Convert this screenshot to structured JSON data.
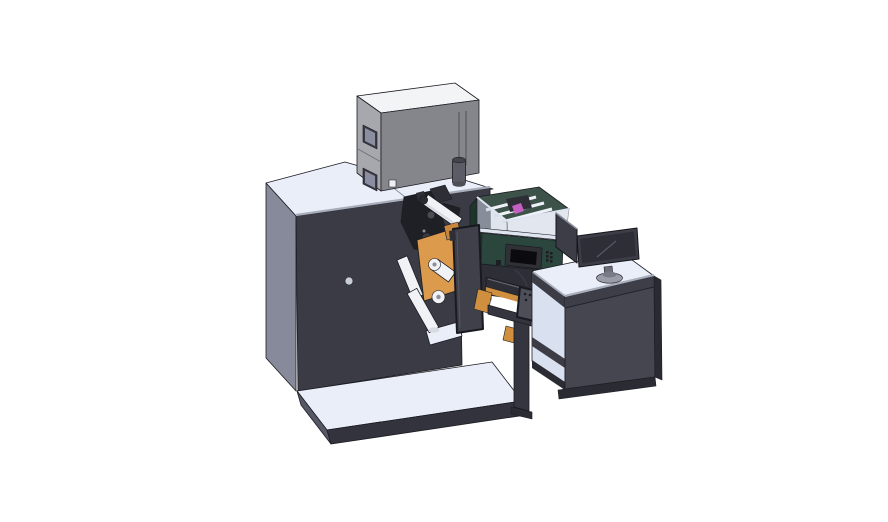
{
  "colors": {
    "background": "#ffffff",
    "top_surface": "#e9eef9",
    "machine_left": "#878a9a",
    "machine_front": "#3b3b46",
    "platform_left": "#565866",
    "platform_front": "#33333d",
    "box_top": "#f3f4f6",
    "box_left": "#a7a8ad",
    "box_front": "#85868c",
    "box_window_frame": "#3b3b46",
    "box_window_glass": "#8b8da0",
    "box_square": "#f0f0f3",
    "cylinder_body": "#5c5c66",
    "cylinder_top": "#44444c",
    "cylinder_base": "#4e4e57",
    "enclosure_glass": "#c7d0e0",
    "enclosure_interior": "#3d5249",
    "enclosure_rib": "#eef1f7",
    "housing_green": "#2b463d",
    "housing_green_dark": "#1f352c",
    "rim_bar": "#dfe5f0",
    "hmi_frame": "#303037",
    "hmi_screen": "#0b0b0f",
    "hmi_button": "#1d1d24",
    "mech_dark": "#1f1f26",
    "mech_mid": "#2e2e36",
    "mech_detail": "#3a3a42",
    "mech_detail2": "#4a4a52",
    "roller_white": "#f0f2f6",
    "roller_shade": "#d8dae2",
    "roller_hub": "#8a8d99",
    "roller_cap": "#2a2a31",
    "orange": "#dc9a4c",
    "orange_wedge": "#c8873c",
    "orange_dark": "#cf8f3f",
    "magenta": "#c45fc4",
    "door_panel": "#40404b",
    "door_tab": "#2e2e36",
    "door_line": "#55555f",
    "conveyor_dark": "#2e2e37",
    "leg_dark": "#35353f",
    "foot_dark": "#2b2b33",
    "desk_front": "#464650",
    "desk_front_upper": "#3e3e48",
    "desk_side_dark": "#2a2a32",
    "desk_interior": "#d9e0ef",
    "desk_member": "#3c3c46",
    "desk_kick": "#2b2b33",
    "monitor_frame": "#3d3d47",
    "monitor_screen": "#2e2e37",
    "monitor_reflection": "#565663",
    "monitor_neck": "#6e6e78",
    "monitor_base": "#9a9ca8",
    "monitor_hub": "#787a86",
    "pendant": "#4e4e58",
    "pendant_dot": "#1d1d24",
    "pendant_cable": "#3a3a44",
    "port_circle": "#c9cdd8",
    "chamfer": "#a7adba",
    "top_shadow_line": "#8a8f9c",
    "seam_line": "#717279",
    "slot_line": "#5e5f66",
    "desk_seam": "#23232b",
    "bar_glint": "#6a6a75"
  }
}
